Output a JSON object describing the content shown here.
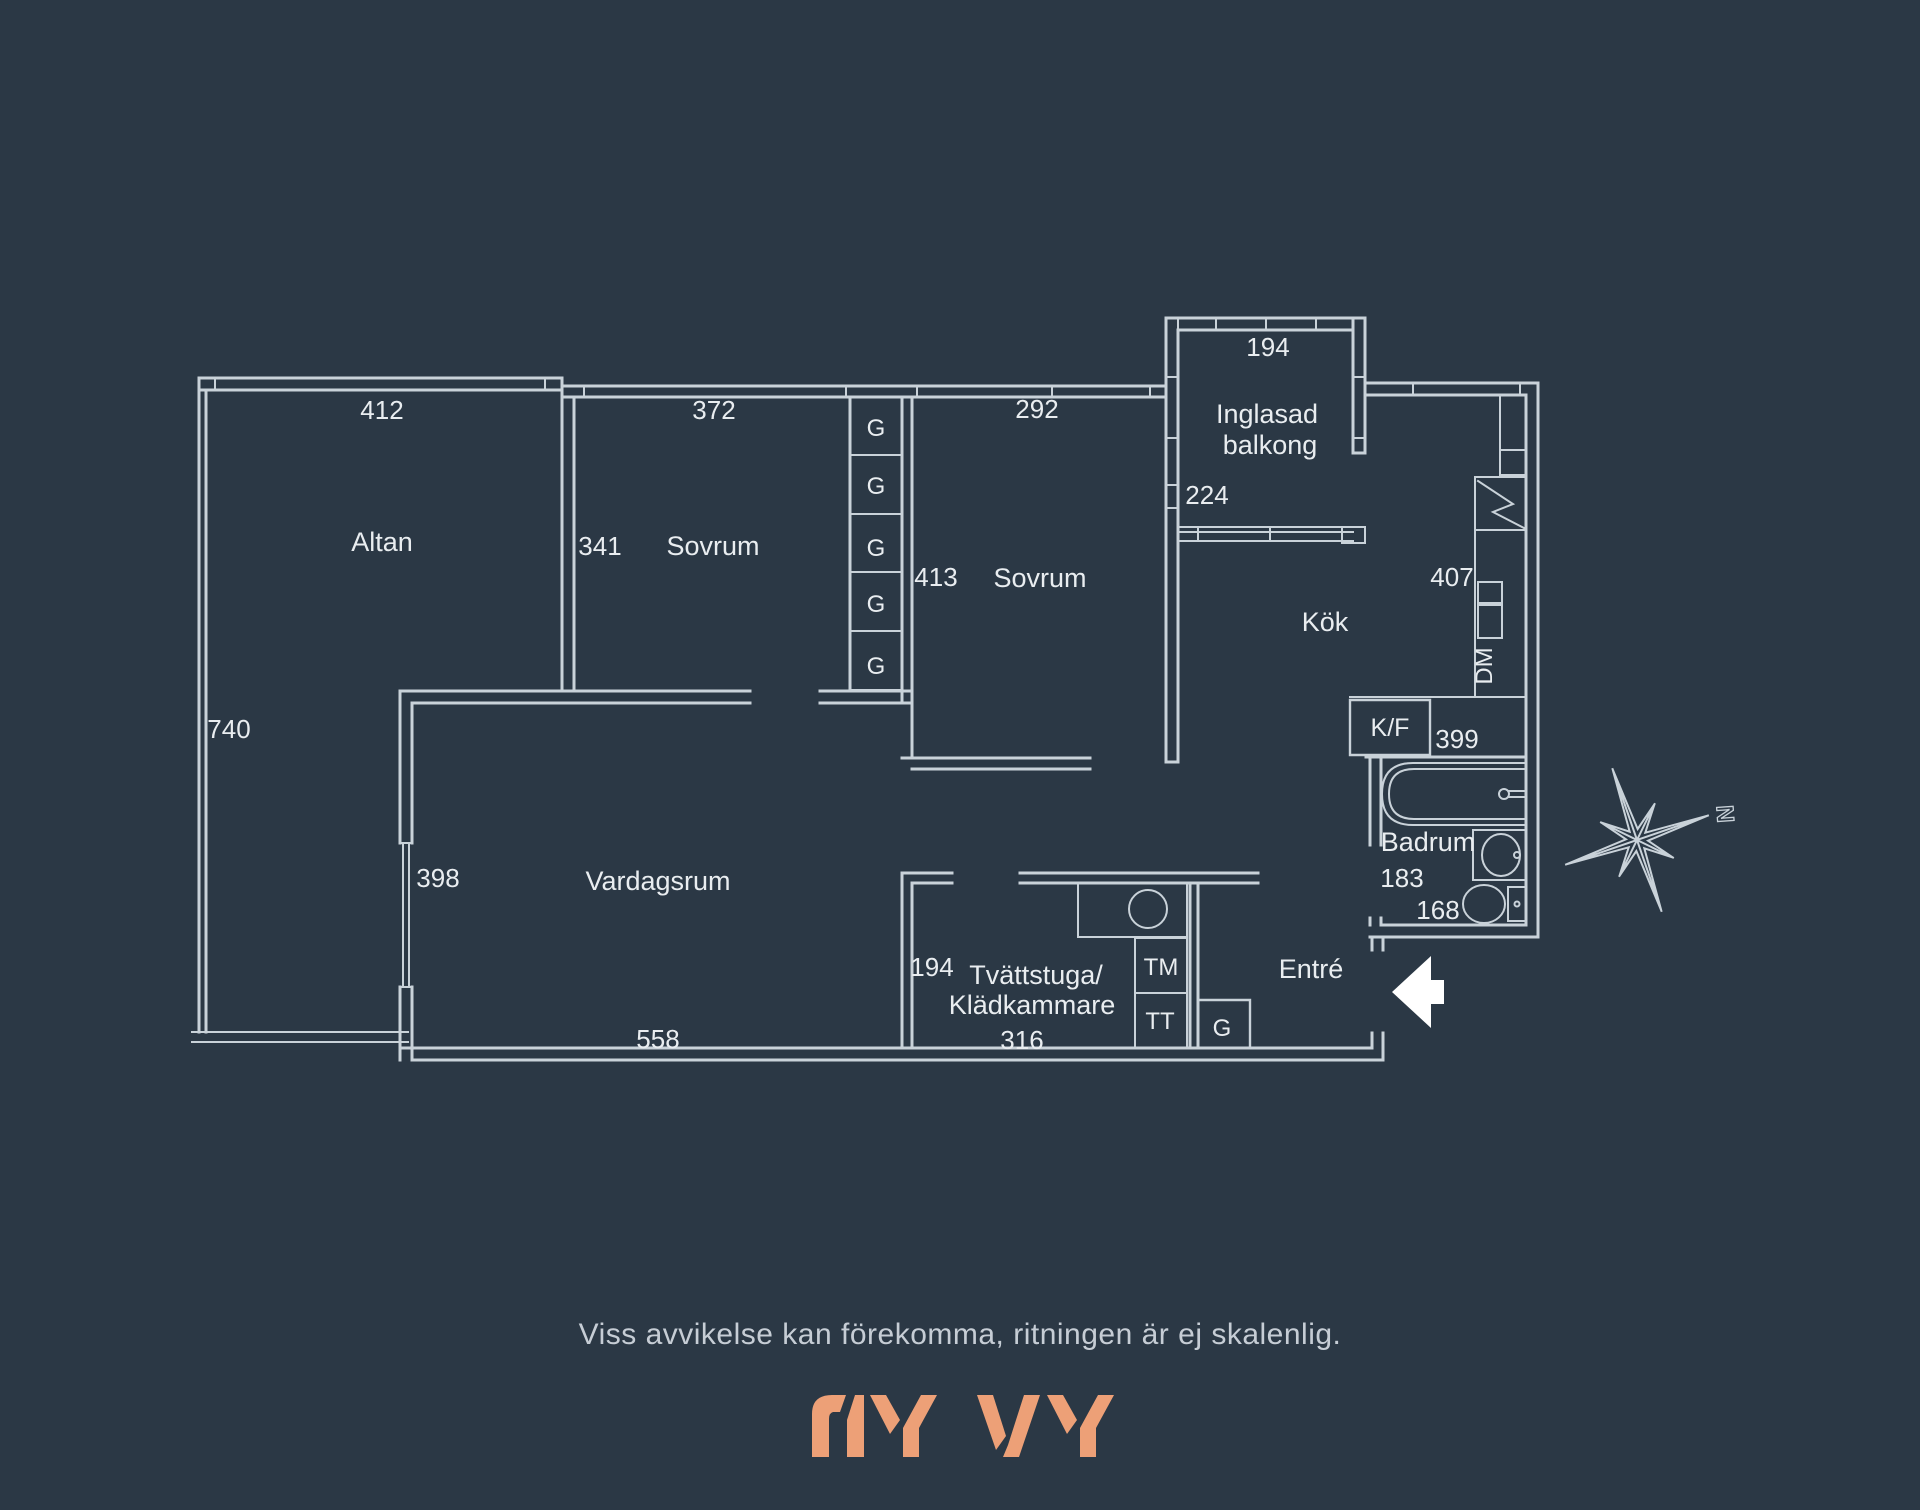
{
  "colors": {
    "background": "#2b3845",
    "lines": "#c9d2d9",
    "text": "#e9edf0",
    "muted_text": "#c6cdd5",
    "logo": "#eda077"
  },
  "plan": {
    "rooms": {
      "altan": {
        "name": "Altan",
        "dim_top": "412",
        "dim_left": "740"
      },
      "sovrum1": {
        "name": "Sovrum",
        "dim_top": "372",
        "dim_left": "341"
      },
      "sovrum2": {
        "name": "Sovrum",
        "dim_top": "292",
        "dim_left": "413"
      },
      "balkong": {
        "name_line1": "Inglasad",
        "name_line2": "balkong",
        "dim_top": "194",
        "dim_left": "224"
      },
      "kok": {
        "name": "Kök",
        "dim_right": "407",
        "dim_bottom": "399"
      },
      "vardagsrum": {
        "name": "Vardagsrum",
        "dim_left": "398",
        "dim_bottom": "558"
      },
      "tvattstuga": {
        "name_line1": "Tvättstuga/",
        "name_line2": "Klädkammare",
        "dim_left": "194",
        "dim_bottom": "316"
      },
      "badrum": {
        "name": "Badrum",
        "dim_a": "183",
        "dim_b": "168"
      },
      "entre": {
        "name": "Entré"
      }
    },
    "appliances": {
      "closet": "G",
      "dishwasher": "DM",
      "fridge_freezer": "K/F",
      "washing_machine": "TM",
      "dryer": "TT"
    },
    "compass": {
      "north": "N"
    }
  },
  "footer": {
    "disclaimer": "Viss avvikelse kan förekomma, ritningen är ej skalenlig.",
    "logo": "NY VY"
  }
}
